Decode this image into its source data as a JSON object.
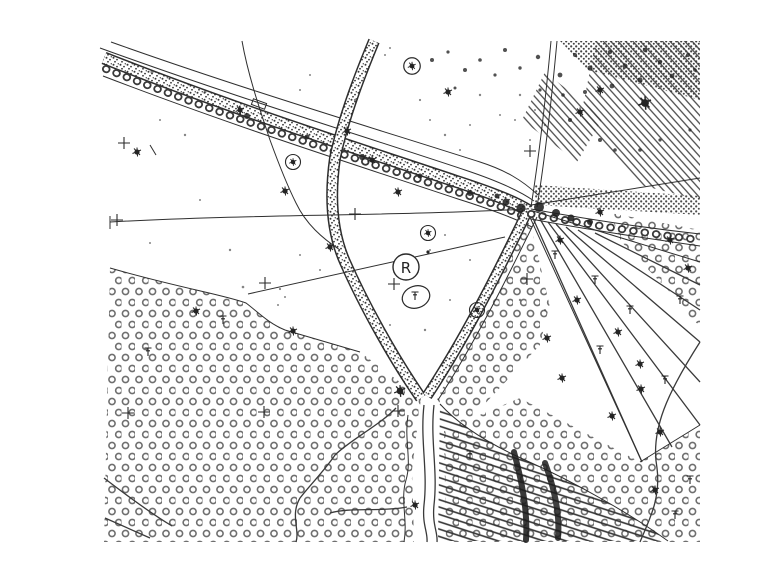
{
  "header": {
    "title": "ODRA, zona R"
  },
  "map": {
    "zone_label": "R",
    "colors": {
      "ink": "#242424",
      "ink_light": "#6b6b6b",
      "paper": "#ffffff"
    },
    "symbols": {
      "ring_pattern": "orchard-meadow-texture",
      "stipple_band": "embankment-road-band",
      "tree_dot_road": "tree-lined-road",
      "hatch_pattern": "field-hatching",
      "strip_parcels": "narrow-strip-parcels",
      "cross": "survey-grid-cross",
      "tree": "tree-symbol",
      "stream": "stream-line",
      "zone_marker": "circled-zone-letter"
    }
  }
}
